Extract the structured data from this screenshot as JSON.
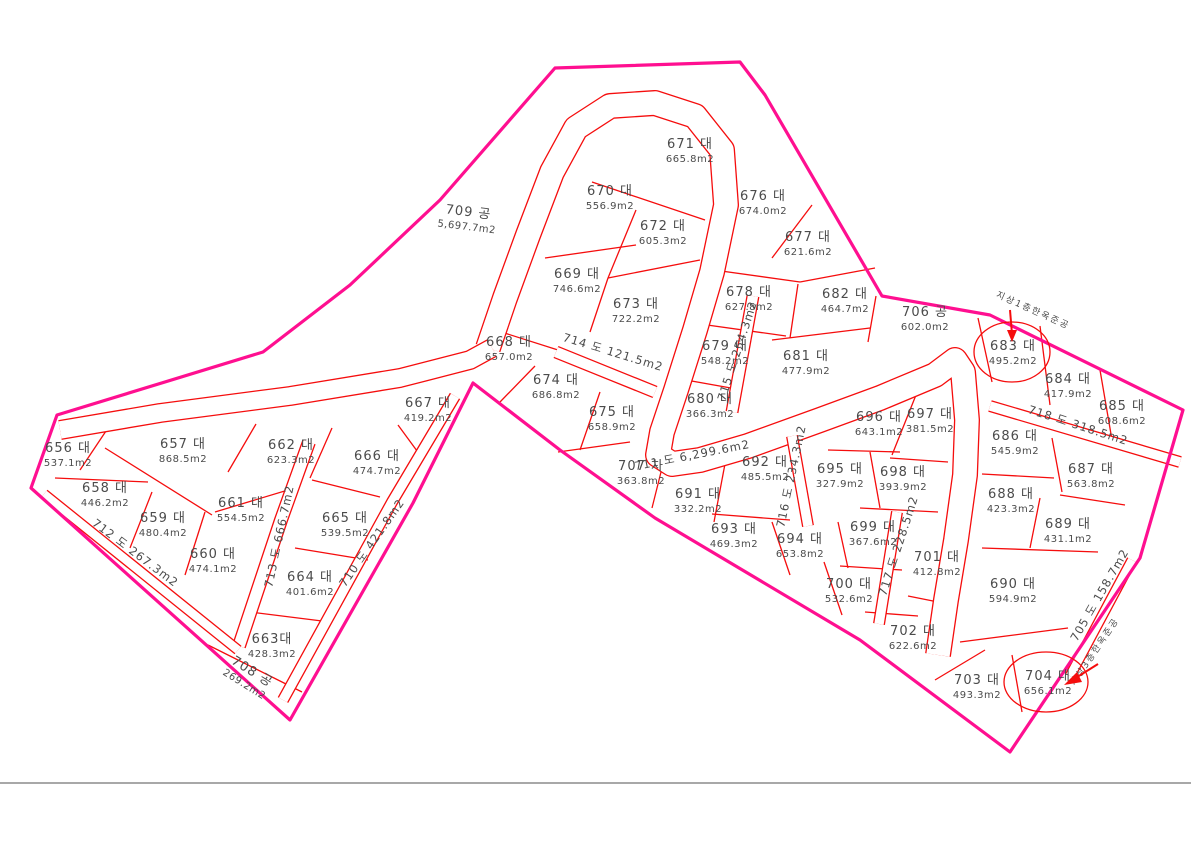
{
  "map": {
    "title": "cadastral-parcel-map",
    "width": 1191,
    "height": 842,
    "background": "#ffffff",
    "boundary_color": "#ff0f90",
    "line_color": "#f50d0d",
    "text_color": "#4b4b4b",
    "baseline_color": "#8c8c8c",
    "baseline_y": 783
  },
  "boundary_points": [
    [
      555,
      68
    ],
    [
      740,
      62
    ],
    [
      765,
      95
    ],
    [
      882,
      296
    ],
    [
      990,
      315
    ],
    [
      1183,
      410
    ],
    [
      1140,
      558
    ],
    [
      1010,
      752
    ],
    [
      860,
      640
    ],
    [
      655,
      518
    ],
    [
      560,
      450
    ],
    [
      473,
      383
    ],
    [
      413,
      503
    ],
    [
      290,
      720
    ],
    [
      31,
      488
    ],
    [
      57,
      415
    ],
    [
      263,
      352
    ],
    [
      350,
      285
    ],
    [
      440,
      200
    ]
  ],
  "roads": [
    {
      "name": "road-711-loop",
      "width": 26,
      "points": [
        [
          488,
          348
        ],
        [
          505,
          298
        ],
        [
          528,
          235
        ],
        [
          552,
          172
        ],
        [
          576,
          128
        ],
        [
          610,
          106
        ],
        [
          655,
          103
        ],
        [
          695,
          116
        ],
        [
          722,
          150
        ],
        [
          726,
          205
        ],
        [
          712,
          272
        ],
        [
          695,
          330
        ],
        [
          676,
          390
        ],
        [
          662,
          432
        ],
        [
          658,
          455
        ],
        [
          672,
          464
        ],
        [
          700,
          460
        ],
        [
          748,
          446
        ],
        [
          820,
          420
        ],
        [
          880,
          398
        ],
        [
          935,
          375
        ],
        [
          955,
          360
        ],
        [
          963,
          372
        ],
        [
          967,
          420
        ],
        [
          965,
          475
        ],
        [
          956,
          540
        ],
        [
          946,
          600
        ],
        [
          938,
          655
        ]
      ]
    },
    {
      "name": "road-711-west-branch",
      "width": 20,
      "points": [
        [
          60,
          430
        ],
        [
          160,
          413
        ],
        [
          290,
          396
        ],
        [
          400,
          378
        ],
        [
          470,
          360
        ],
        [
          492,
          348
        ]
      ]
    },
    {
      "name": "road-714",
      "width": 13,
      "points": [
        [
          556,
          352
        ],
        [
          655,
          392
        ]
      ]
    },
    {
      "name": "road-715",
      "width": 13,
      "points": [
        [
          753,
          296
        ],
        [
          732,
          412
        ]
      ]
    },
    {
      "name": "road-716",
      "width": 12,
      "points": [
        [
          792,
          436
        ],
        [
          808,
          526
        ]
      ]
    },
    {
      "name": "road-717",
      "width": 12,
      "points": [
        [
          897,
          512
        ],
        [
          879,
          624
        ]
      ]
    },
    {
      "name": "road-718",
      "width": 12,
      "points": [
        [
          990,
          406
        ],
        [
          1180,
          462
        ]
      ]
    },
    {
      "name": "road-705",
      "width": 11,
      "points": [
        [
          1132,
          560
        ],
        [
          1070,
          676
        ]
      ]
    },
    {
      "name": "road-713",
      "width": 14,
      "points": [
        [
          309,
          442
        ],
        [
          281,
          520
        ],
        [
          239,
          646
        ]
      ]
    },
    {
      "name": "road-712",
      "width": 11,
      "points": [
        [
          44,
          494
        ],
        [
          238,
          650
        ]
      ]
    },
    {
      "name": "road-710",
      "width": 12,
      "points": [
        [
          455,
          396
        ],
        [
          392,
          502
        ],
        [
          283,
          700
        ]
      ]
    }
  ],
  "dividers": [
    [
      110,
      425,
      80,
      470
    ],
    [
      55,
      478,
      148,
      482
    ],
    [
      105,
      448,
      212,
      515
    ],
    [
      152,
      492,
      130,
      548
    ],
    [
      205,
      512,
      185,
      575
    ],
    [
      256,
      424,
      228,
      472
    ],
    [
      215,
      512,
      298,
      487
    ],
    [
      332,
      428,
      310,
      478
    ],
    [
      312,
      480,
      380,
      497
    ],
    [
      398,
      425,
      420,
      455
    ],
    [
      295,
      548,
      368,
      560
    ],
    [
      250,
      612,
      330,
      622
    ],
    [
      208,
      645,
      302,
      692
    ],
    [
      592,
      182,
      705,
      220
    ],
    [
      636,
      210,
      608,
      278
    ],
    [
      545,
      258,
      636,
      245
    ],
    [
      608,
      278,
      700,
      260
    ],
    [
      608,
      278,
      590,
      332
    ],
    [
      495,
      330,
      558,
      350
    ],
    [
      535,
      366,
      500,
      402
    ],
    [
      600,
      392,
      580,
      450
    ],
    [
      558,
      452,
      630,
      442
    ],
    [
      666,
      452,
      652,
      508
    ],
    [
      812,
      205,
      772,
      258
    ],
    [
      714,
      270,
      800,
      282
    ],
    [
      800,
      282,
      875,
      268
    ],
    [
      798,
      284,
      790,
      338
    ],
    [
      700,
      324,
      786,
      336
    ],
    [
      686,
      380,
      742,
      390
    ],
    [
      772,
      340,
      870,
      328
    ],
    [
      876,
      296,
      868,
      342
    ],
    [
      978,
      318,
      992,
      382
    ],
    [
      1040,
      326,
      1050,
      405
    ],
    [
      1100,
      370,
      1112,
      440
    ],
    [
      1052,
      438,
      1062,
      492
    ],
    [
      982,
      474,
      1054,
      478
    ],
    [
      1040,
      498,
      1030,
      548
    ],
    [
      1060,
      495,
      1125,
      505
    ],
    [
      982,
      548,
      1098,
      552
    ],
    [
      960,
      642,
      1068,
      628
    ],
    [
      728,
      448,
      714,
      522
    ],
    [
      712,
      514,
      790,
      520
    ],
    [
      772,
      522,
      790,
      575
    ],
    [
      824,
      562,
      842,
      615
    ],
    [
      828,
      450,
      900,
      452
    ],
    [
      870,
      452,
      880,
      508
    ],
    [
      918,
      390,
      892,
      455
    ],
    [
      890,
      458,
      948,
      462
    ],
    [
      860,
      508,
      938,
      512
    ],
    [
      838,
      522,
      848,
      568
    ],
    [
      840,
      566,
      902,
      570
    ],
    [
      865,
      612,
      918,
      616
    ],
    [
      908,
      596,
      958,
      606
    ],
    [
      935,
      680,
      985,
      650
    ],
    [
      1012,
      655,
      1022,
      712
    ]
  ],
  "parcels": [
    {
      "id": "656",
      "label": "656 대",
      "area": "537.1m2",
      "x": 68,
      "y": 452,
      "rot": 0
    },
    {
      "id": "657",
      "label": "657 대",
      "area": "868.5m2",
      "x": 183,
      "y": 448,
      "rot": 0
    },
    {
      "id": "658",
      "label": "658 대",
      "area": "446.2m2",
      "x": 105,
      "y": 492,
      "rot": 0
    },
    {
      "id": "659",
      "label": "659 대",
      "area": "480.4m2",
      "x": 163,
      "y": 522,
      "rot": 0
    },
    {
      "id": "660",
      "label": "660 대",
      "area": "474.1m2",
      "x": 213,
      "y": 558,
      "rot": 0
    },
    {
      "id": "661",
      "label": "661 대",
      "area": "554.5m2",
      "x": 241,
      "y": 507,
      "rot": 0
    },
    {
      "id": "662",
      "label": "662 대",
      "area": "623.3m2",
      "x": 291,
      "y": 449,
      "rot": 0
    },
    {
      "id": "663",
      "label": "663대",
      "area": "428.3m2",
      "x": 272,
      "y": 643,
      "rot": 0
    },
    {
      "id": "664",
      "label": "664 대",
      "area": "401.6m2",
      "x": 310,
      "y": 581,
      "rot": 0
    },
    {
      "id": "665",
      "label": "665 대",
      "area": "539.5m2",
      "x": 345,
      "y": 522,
      "rot": 0
    },
    {
      "id": "666",
      "label": "666 대",
      "area": "474.7m2",
      "x": 377,
      "y": 460,
      "rot": 0
    },
    {
      "id": "667",
      "label": "667 대",
      "area": "419.2m2",
      "x": 428,
      "y": 407,
      "rot": 0
    },
    {
      "id": "668",
      "label": "668 대",
      "area": "657.0m2",
      "x": 509,
      "y": 346,
      "rot": 0
    },
    {
      "id": "669",
      "label": "669 대",
      "area": "746.6m2",
      "x": 577,
      "y": 278,
      "rot": 0
    },
    {
      "id": "670",
      "label": "670 대",
      "area": "556.9m2",
      "x": 610,
      "y": 195,
      "rot": 0
    },
    {
      "id": "671",
      "label": "671 대",
      "area": "665.8m2",
      "x": 690,
      "y": 148,
      "rot": 0
    },
    {
      "id": "672",
      "label": "672 대",
      "area": "605.3m2",
      "x": 663,
      "y": 230,
      "rot": 0
    },
    {
      "id": "673",
      "label": "673 대",
      "area": "722.2m2",
      "x": 636,
      "y": 308,
      "rot": 0
    },
    {
      "id": "674",
      "label": "674 대",
      "area": "686.8m2",
      "x": 556,
      "y": 384,
      "rot": 0
    },
    {
      "id": "675",
      "label": "675 대",
      "area": "658.9m2",
      "x": 612,
      "y": 416,
      "rot": 0
    },
    {
      "id": "676",
      "label": "676 대",
      "area": "674.0m2",
      "x": 763,
      "y": 200,
      "rot": 0
    },
    {
      "id": "677",
      "label": "677 대",
      "area": "621.6m2",
      "x": 808,
      "y": 241,
      "rot": 0
    },
    {
      "id": "678",
      "label": "678 대",
      "area": "627.8m2",
      "x": 749,
      "y": 296,
      "rot": 0
    },
    {
      "id": "679",
      "label": "679 대",
      "area": "548.2m2",
      "x": 725,
      "y": 350,
      "rot": 0
    },
    {
      "id": "680",
      "label": "680 대",
      "area": "366.3m2",
      "x": 710,
      "y": 403,
      "rot": 0
    },
    {
      "id": "681",
      "label": "681 대",
      "area": "477.9m2",
      "x": 806,
      "y": 360,
      "rot": 0
    },
    {
      "id": "682",
      "label": "682 대",
      "area": "464.7m2",
      "x": 845,
      "y": 298,
      "rot": 0
    },
    {
      "id": "683",
      "label": "683 대",
      "area": "495.2m2",
      "x": 1013,
      "y": 350,
      "rot": 0
    },
    {
      "id": "684",
      "label": "684 대",
      "area": "417.9m2",
      "x": 1068,
      "y": 383,
      "rot": 0
    },
    {
      "id": "685",
      "label": "685 대",
      "area": "608.6m2",
      "x": 1122,
      "y": 410,
      "rot": 0
    },
    {
      "id": "686",
      "label": "686 대",
      "area": "545.9m2",
      "x": 1015,
      "y": 440,
      "rot": 0
    },
    {
      "id": "687",
      "label": "687 대",
      "area": "563.8m2",
      "x": 1091,
      "y": 473,
      "rot": 0
    },
    {
      "id": "688",
      "label": "688 대",
      "area": "423.3m2",
      "x": 1011,
      "y": 498,
      "rot": 0
    },
    {
      "id": "689",
      "label": "689 대",
      "area": "431.1m2",
      "x": 1068,
      "y": 528,
      "rot": 0
    },
    {
      "id": "690",
      "label": "690 대",
      "area": "594.9m2",
      "x": 1013,
      "y": 588,
      "rot": 0
    },
    {
      "id": "691",
      "label": "691 대",
      "area": "332.2m2",
      "x": 698,
      "y": 498,
      "rot": 0
    },
    {
      "id": "692",
      "label": "692 대",
      "area": "485.5m2",
      "x": 765,
      "y": 466,
      "rot": 0
    },
    {
      "id": "693",
      "label": "693 대",
      "area": "469.3m2",
      "x": 734,
      "y": 533,
      "rot": 0
    },
    {
      "id": "694",
      "label": "694 대",
      "area": "653.8m2",
      "x": 800,
      "y": 543,
      "rot": 0
    },
    {
      "id": "695",
      "label": "695 대",
      "area": "327.9m2",
      "x": 840,
      "y": 473,
      "rot": 0
    },
    {
      "id": "696",
      "label": "696 대",
      "area": "643.1m2",
      "x": 879,
      "y": 421,
      "rot": 0
    },
    {
      "id": "697",
      "label": "697 대",
      "area": "381.5m2",
      "x": 930,
      "y": 418,
      "rot": 0
    },
    {
      "id": "698",
      "label": "698 대",
      "area": "393.9m2",
      "x": 903,
      "y": 476,
      "rot": 0
    },
    {
      "id": "699",
      "label": "699 대",
      "area": "367.6m2",
      "x": 873,
      "y": 531,
      "rot": 0
    },
    {
      "id": "700",
      "label": "700 대",
      "area": "532.6m2",
      "x": 849,
      "y": 588,
      "rot": 0
    },
    {
      "id": "701",
      "label": "701 대",
      "area": "412.8m2",
      "x": 937,
      "y": 561,
      "rot": 0
    },
    {
      "id": "702",
      "label": "702 대",
      "area": "622.6m2",
      "x": 913,
      "y": 635,
      "rot": 0
    },
    {
      "id": "703",
      "label": "703 대",
      "area": "493.3m2",
      "x": 977,
      "y": 684,
      "rot": 0
    },
    {
      "id": "704",
      "label": "704 대",
      "area": "656.1m2",
      "x": 1048,
      "y": 680,
      "rot": 0
    },
    {
      "id": "706",
      "label": "706 공",
      "area": "602.0m2",
      "x": 925,
      "y": 316,
      "rot": 0
    },
    {
      "id": "707",
      "label": "707 차",
      "area": "363.8m2",
      "x": 641,
      "y": 470,
      "rot": 0
    },
    {
      "id": "708",
      "label": "708 공",
      "area": "269.2m2",
      "x": 250,
      "y": 675,
      "rot": 32
    },
    {
      "id": "709",
      "label": "709 공",
      "area": "5,697.7m2",
      "x": 468,
      "y": 216,
      "rot": 7
    }
  ],
  "road_labels": [
    {
      "id": "711",
      "label": "711 도",
      "area": "6,299.6m2",
      "x": 693,
      "y": 459,
      "rot": -11
    },
    {
      "id": "712",
      "label": "712 도",
      "area": "267.3m2",
      "x": 133,
      "y": 556,
      "rot": 37
    },
    {
      "id": "713",
      "label": "713 도",
      "area": "666.7m2",
      "x": 283,
      "y": 537,
      "rot": -78
    },
    {
      "id": "710",
      "label": "710 도",
      "area": "421.8m2",
      "x": 375,
      "y": 545,
      "rot": -55
    },
    {
      "id": "714",
      "label": "714 도",
      "area": "121.5m2",
      "x": 612,
      "y": 356,
      "rot": 17
    },
    {
      "id": "715",
      "label": "715 도",
      "area": "254.3m2",
      "x": 741,
      "y": 352,
      "rot": -72
    },
    {
      "id": "716",
      "label": "716 도",
      "area": "234.3m2",
      "x": 795,
      "y": 477,
      "rot": -78
    },
    {
      "id": "717",
      "label": "717 도",
      "area": "228.5m2",
      "x": 902,
      "y": 547,
      "rot": -72
    },
    {
      "id": "718",
      "label": "718 도",
      "area": "318.5m2",
      "x": 1077,
      "y": 429,
      "rot": 18
    },
    {
      "id": "705",
      "label": "705 도",
      "area": "158.7m2",
      "x": 1103,
      "y": 597,
      "rot": -60
    }
  ],
  "annotations": [
    {
      "text": "지상1층한옥준공",
      "x": 1032,
      "y": 313,
      "rot": 24
    },
    {
      "text": "지상3층한옥준공",
      "x": 1097,
      "y": 653,
      "rot": -56
    }
  ],
  "highlights": [
    {
      "target": "683",
      "cx": 1012,
      "cy": 352,
      "rx": 38,
      "ry": 30
    },
    {
      "target": "704",
      "cx": 1046,
      "cy": 682,
      "rx": 42,
      "ry": 30
    }
  ],
  "arrows": [
    {
      "target": "683",
      "line": [
        1010,
        310,
        1012,
        334
      ],
      "head": [
        [
          1012,
          342
        ],
        [
          1007,
          330
        ],
        [
          1017,
          330
        ]
      ]
    },
    {
      "target": "704",
      "line": [
        1098,
        664,
        1074,
        679
      ],
      "head": [
        [
          1064,
          685
        ],
        [
          1077,
          672
        ],
        [
          1082,
          682
        ]
      ]
    }
  ]
}
